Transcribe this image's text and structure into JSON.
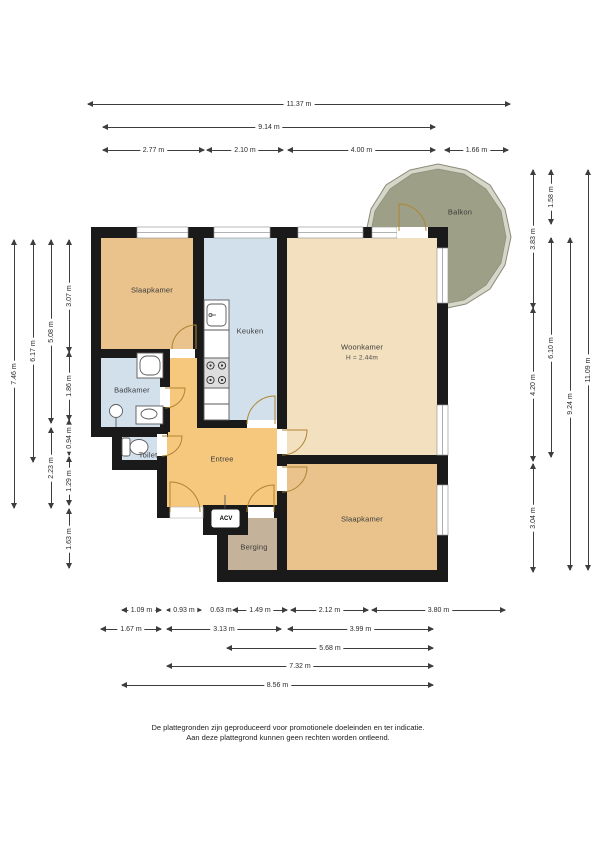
{
  "rooms": {
    "slaapkamer_left": {
      "label": "Slaapkamer"
    },
    "keuken": {
      "label": "Keuken"
    },
    "woonkamer": {
      "label": "Woonkamer",
      "note": "H = 2.44m"
    },
    "balkon": {
      "label": "Balkon"
    },
    "badkamer": {
      "label": "Badkamer"
    },
    "toilet": {
      "label": "Toilet"
    },
    "entree": {
      "label": "Entree"
    },
    "berging": {
      "label": "Berging"
    },
    "slaapkamer_right": {
      "label": "Slaapkamer"
    },
    "acv_unit": {
      "label": "ACV"
    }
  },
  "dimensions": {
    "top": [
      {
        "label": "11.37 m",
        "a": 88,
        "b": 510,
        "p": 104
      },
      {
        "label": "9.14 m",
        "a": 103,
        "b": 435,
        "p": 127
      },
      {
        "label": "2.77 m",
        "a": 103,
        "b": 204,
        "p": 150
      },
      {
        "label": "2.10 m",
        "a": 207,
        "b": 283,
        "p": 150
      },
      {
        "label": "4.00 m",
        "a": 288,
        "b": 435,
        "p": 150
      },
      {
        "label": "1.66 m",
        "a": 445,
        "b": 508,
        "p": 150
      }
    ],
    "left": [
      {
        "label": "7.46 m",
        "a": 240,
        "b": 508,
        "p": 14
      },
      {
        "label": "6.17 m",
        "a": 240,
        "b": 462,
        "p": 33
      },
      {
        "label": "5.08 m",
        "a": 240,
        "b": 423,
        "p": 51
      },
      {
        "label": "2.23 m",
        "a": 428,
        "b": 508,
        "p": 51
      },
      {
        "label": "3.07 m",
        "a": 240,
        "b": 352,
        "p": 69
      },
      {
        "label": "1.86 m",
        "a": 352,
        "b": 420,
        "p": 69
      },
      {
        "label": "0.94 m",
        "a": 420,
        "b": 455,
        "p": 69
      },
      {
        "label": "1.29 m",
        "a": 457,
        "b": 505,
        "p": 69
      },
      {
        "label": "1.63 m",
        "a": 509,
        "b": 568,
        "p": 69
      }
    ],
    "right": [
      {
        "label": "3.83 m",
        "a": 170,
        "b": 308,
        "p": 533
      },
      {
        "label": "4.20 m",
        "a": 308,
        "b": 461,
        "p": 533
      },
      {
        "label": "3.04 m",
        "a": 464,
        "b": 572,
        "p": 533
      },
      {
        "label": "1.58 m",
        "a": 170,
        "b": 224,
        "p": 551
      },
      {
        "label": "6.10 m",
        "a": 238,
        "b": 457,
        "p": 551
      },
      {
        "label": "9.24 m",
        "a": 238,
        "b": 570,
        "p": 570
      },
      {
        "label": "11.09 m",
        "a": 170,
        "b": 570,
        "p": 588
      }
    ],
    "bottom": [
      {
        "label": "1.09 m",
        "a": 122,
        "b": 161,
        "p": 610
      },
      {
        "label": "0.93 m",
        "a": 167,
        "b": 201,
        "p": 610
      },
      {
        "label": "0.63 m",
        "a": 209,
        "b": 233,
        "p": 610
      },
      {
        "label": "1.49 m",
        "a": 233,
        "b": 287,
        "p": 610
      },
      {
        "label": "2.12 m",
        "a": 291,
        "b": 368,
        "p": 610
      },
      {
        "label": "3.80 m",
        "a": 372,
        "b": 505,
        "p": 610
      },
      {
        "label": "1.67 m",
        "a": 101,
        "b": 161,
        "p": 629
      },
      {
        "label": "3.13 m",
        "a": 167,
        "b": 281,
        "p": 629
      },
      {
        "label": "3.99 m",
        "a": 288,
        "b": 433,
        "p": 629
      },
      {
        "label": "5.68 m",
        "a": 227,
        "b": 433,
        "p": 648
      },
      {
        "label": "7.32 m",
        "a": 167,
        "b": 433,
        "p": 666
      },
      {
        "label": "8.56 m",
        "a": 122,
        "b": 433,
        "p": 685
      }
    ]
  },
  "footer": {
    "line1": "De plattegronden zijn geproduceerd voor promotionele doeleinden en ter indicatie.",
    "line2": "Aan deze plattegrond kunnen geen rechten worden ontleend."
  },
  "colors": {
    "wall": "#1a1a1a",
    "bedroom": "#e9c28c",
    "living": "#f3e0bf",
    "kitchen_bath": "#d2e0ec",
    "hall": "#f6c87e",
    "storage": "#c4b29a",
    "balcony": "#9da086",
    "balcony_rim": "#d6d6c9",
    "door_arc": "#b08432"
  }
}
